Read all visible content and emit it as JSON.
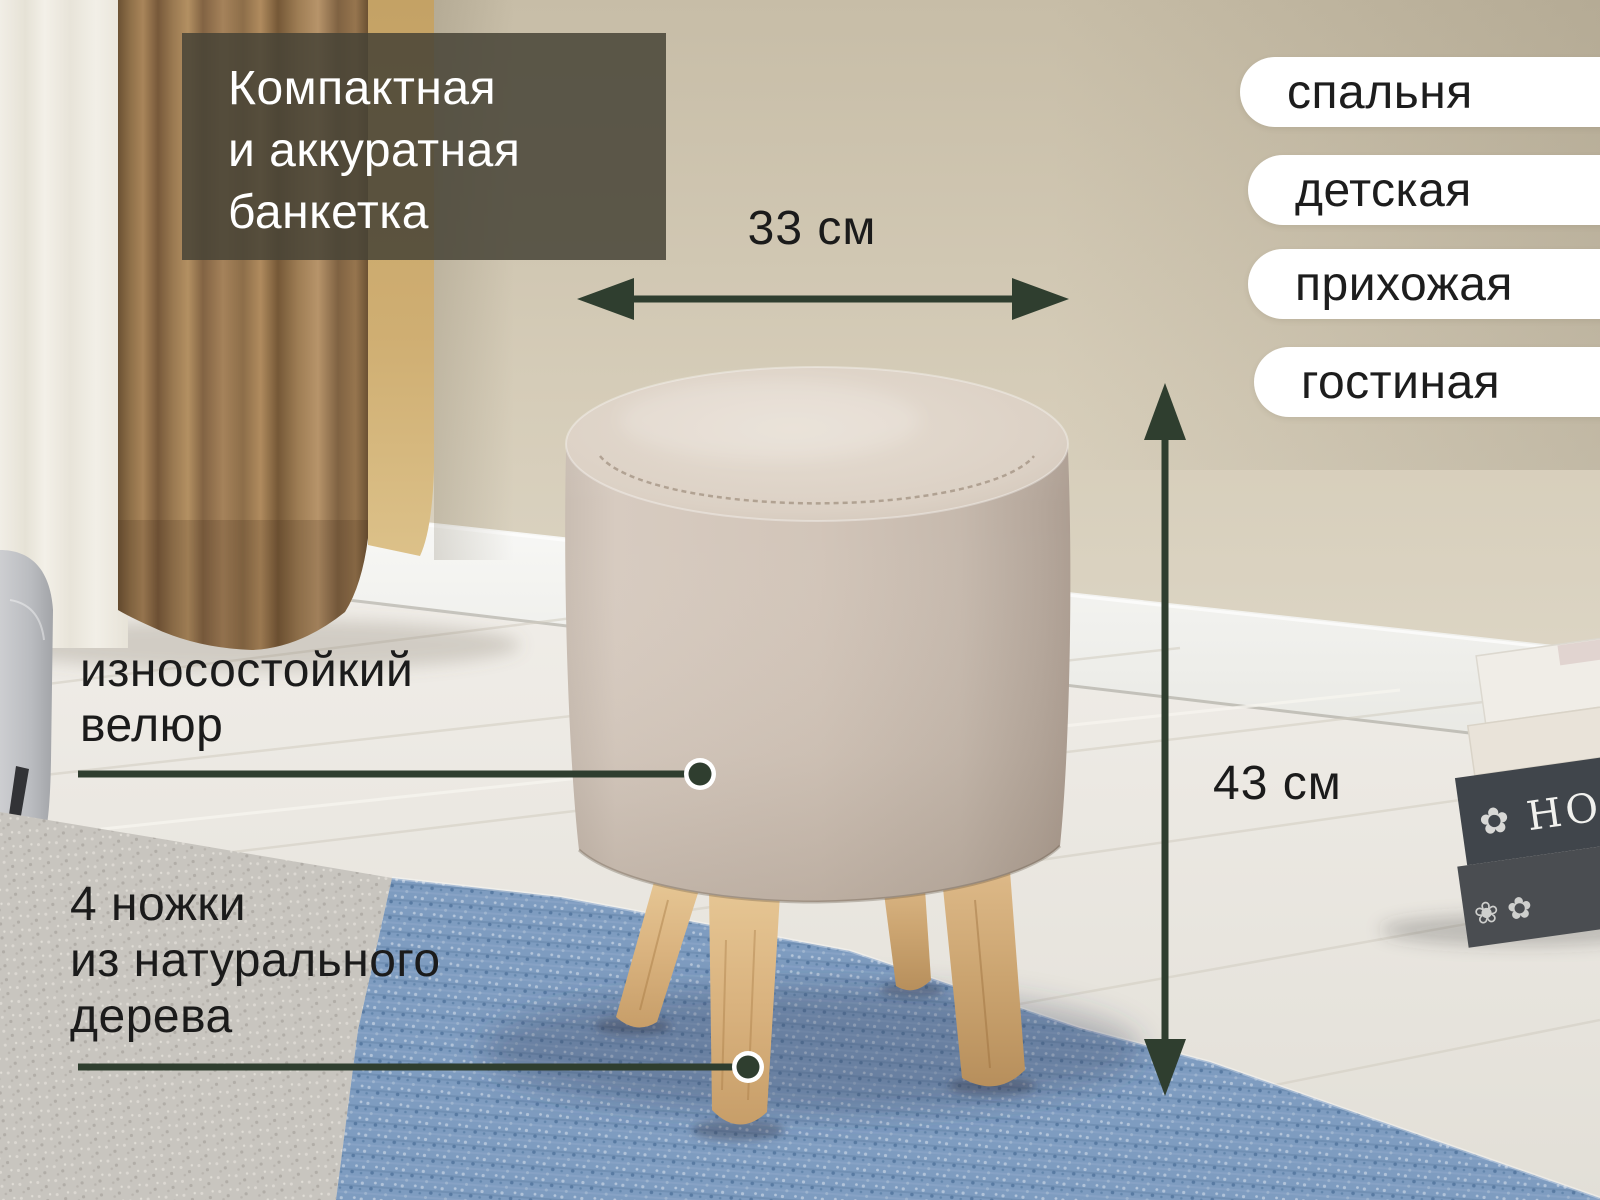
{
  "annotations": {
    "headline_lines": [
      "Компактная",
      "и аккуратная",
      "банкетка"
    ],
    "width_label": "33 см",
    "height_label": "43 см",
    "velour_lines": [
      "износостойкий",
      "велюр"
    ],
    "legs_lines": [
      "4 ножки",
      "из натурального",
      "дерева"
    ]
  },
  "room_tags": [
    "спальня",
    "детская",
    "прихожая",
    "гостиная"
  ],
  "book": {
    "spine_text": "HOME"
  },
  "icons": {
    "book_ornament": "✿",
    "book_ornament_row": "❀ ✿"
  },
  "colors": {
    "accent_green": "#2f3e2f",
    "headline_bg": "rgba(71,67,54,0.85)",
    "headline_text": "#ffffff",
    "tag_bg": "#ffffff",
    "tag_text": "#1d1d1d",
    "label_text": "#1b1b1b",
    "ottoman_fabric": "#d2c5b9",
    "leg_wood": "#d9b27e",
    "rug_blue": "#7e9cc0",
    "wall_beige": "#d3c9b4",
    "curtain_brown": "#9a7951"
  }
}
